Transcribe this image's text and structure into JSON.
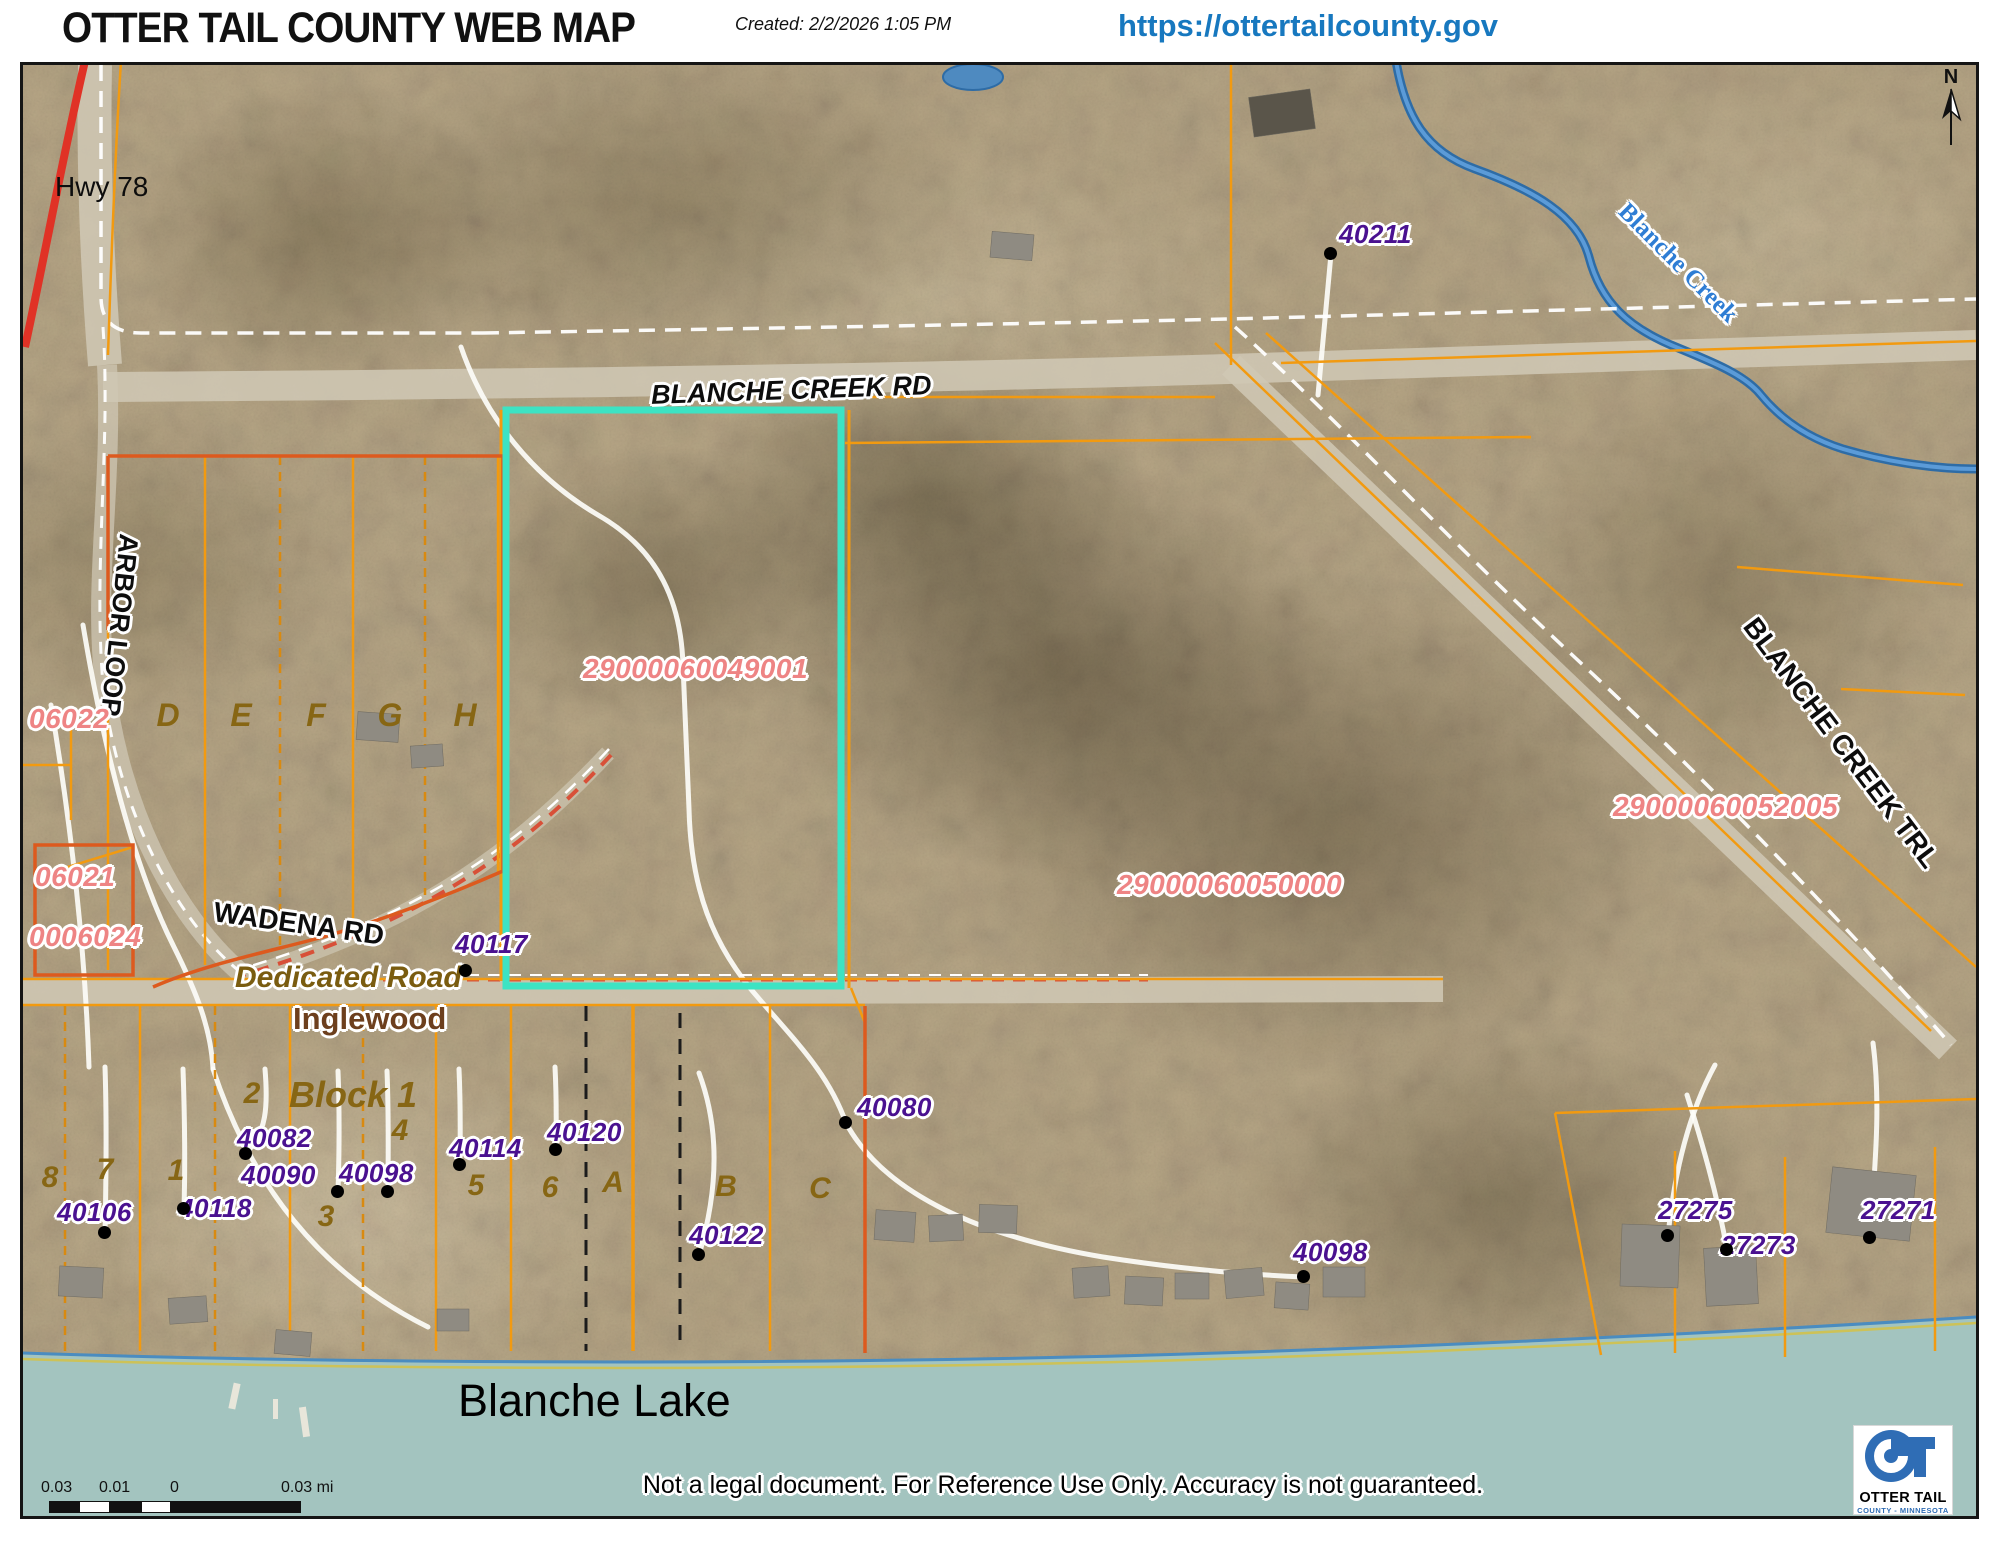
{
  "header": {
    "title": "OTTER TAIL COUNTY WEB MAP",
    "created": "Created: 2/2/2026 1:05 PM",
    "url": "https://ottertailcounty.gov"
  },
  "map": {
    "north_label": "N",
    "roads": {
      "hwy78": "Hwy 78",
      "blanche_creek_rd": "BLANCHE CREEK RD",
      "wadena_rd": "WADENA RD",
      "blanche_creek_trl": "BLANCHE CREEK TRL",
      "arbor_loop": "ARBOR LOOP",
      "dedicated_road": "Dedicated Road"
    },
    "water": {
      "creek": "Blanche Creek",
      "lake": "Blanche Lake"
    },
    "places": {
      "inglewood": "Inglewood",
      "block1": "Block 1"
    },
    "parcels": [
      {
        "id": "06022"
      },
      {
        "id": "06021"
      },
      {
        "id": "0006024"
      },
      {
        "id": "29000060049001"
      },
      {
        "id": "29000060050000"
      },
      {
        "id": "29000060052005"
      }
    ],
    "points": [
      {
        "id": "40211"
      },
      {
        "id": "40117"
      },
      {
        "id": "40082"
      },
      {
        "id": "40090"
      },
      {
        "id": "40098"
      },
      {
        "id": "40106"
      },
      {
        "id": "40118"
      },
      {
        "id": "40114"
      },
      {
        "id": "40120"
      },
      {
        "id": "40122"
      },
      {
        "id": "40080"
      },
      {
        "id": "40098"
      },
      {
        "id": "27275"
      },
      {
        "id": "27273"
      },
      {
        "id": "27271"
      }
    ],
    "letters": [
      "D",
      "E",
      "F",
      "G",
      "H"
    ],
    "numbers": [
      "8",
      "7",
      "1",
      "2",
      "3",
      "4",
      "5",
      "6"
    ],
    "sublots": [
      "A",
      "B",
      "C"
    ],
    "scalebar": [
      "0.03",
      "0.01",
      "0",
      "0.03 mi"
    ],
    "disclaimer": "Not a legal document. For Reference Use Only.  Accuracy is not guaranteed.",
    "logo": {
      "line1": "OTTER TAIL",
      "line2": "COUNTY - MINNESOTA"
    },
    "colors": {
      "highlight_cyan": "#3de3c3",
      "parcel_orange": "#f29a10",
      "outline_red_orange": "#dd5a1e",
      "parcel_label_pink": "#ee8484",
      "point_label_purple": "#4a1190",
      "lot_label_olive": "#876614",
      "url_blue": "#1778bf",
      "creek_blue": "#2e6ca6",
      "lake_teal": "#a3c4bf",
      "highway_red": "#e03226"
    }
  }
}
